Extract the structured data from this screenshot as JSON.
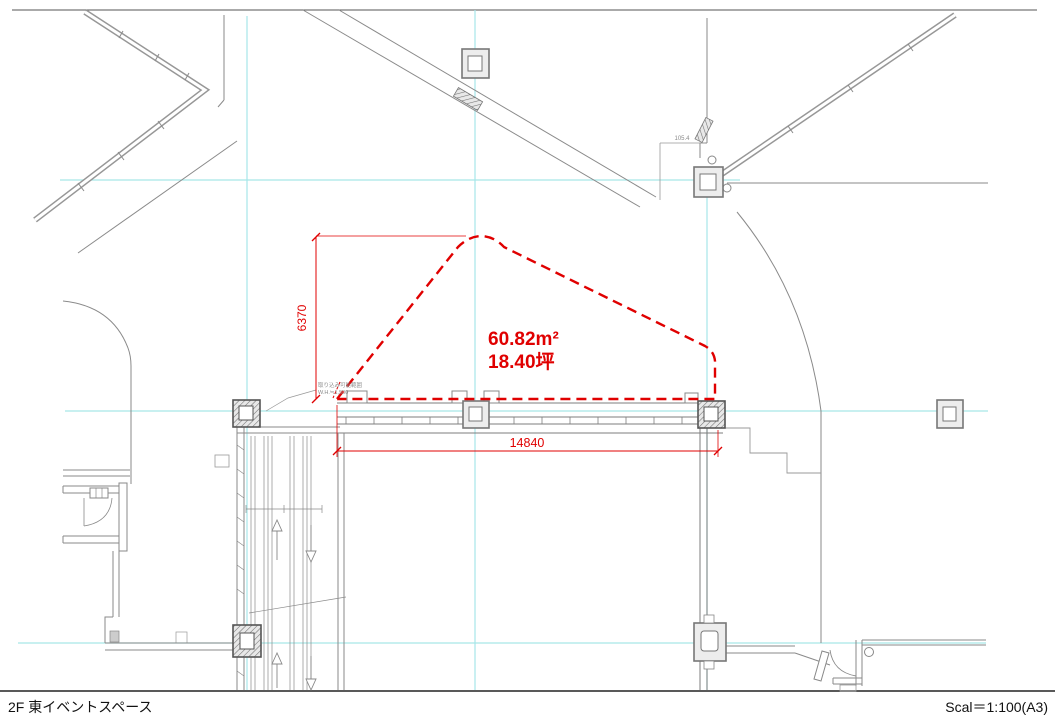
{
  "drawing": {
    "area": {
      "m2": "60.82m²",
      "tsubo": "18.40坪"
    },
    "dimensions": {
      "vertical": "6370",
      "horizontal": "14840",
      "small": "105.4"
    },
    "notes": {
      "line1": "取り込み可能範囲",
      "line2": "W.H.≒1,500"
    }
  },
  "footer": {
    "title": "2F 東イベントスペース",
    "scale": "Scal＝1:100(A3)"
  },
  "colors": {
    "dimension_red": "#e00000",
    "grid_cyan": "#a6e6e8",
    "line_gray": "#8a8a8a"
  }
}
